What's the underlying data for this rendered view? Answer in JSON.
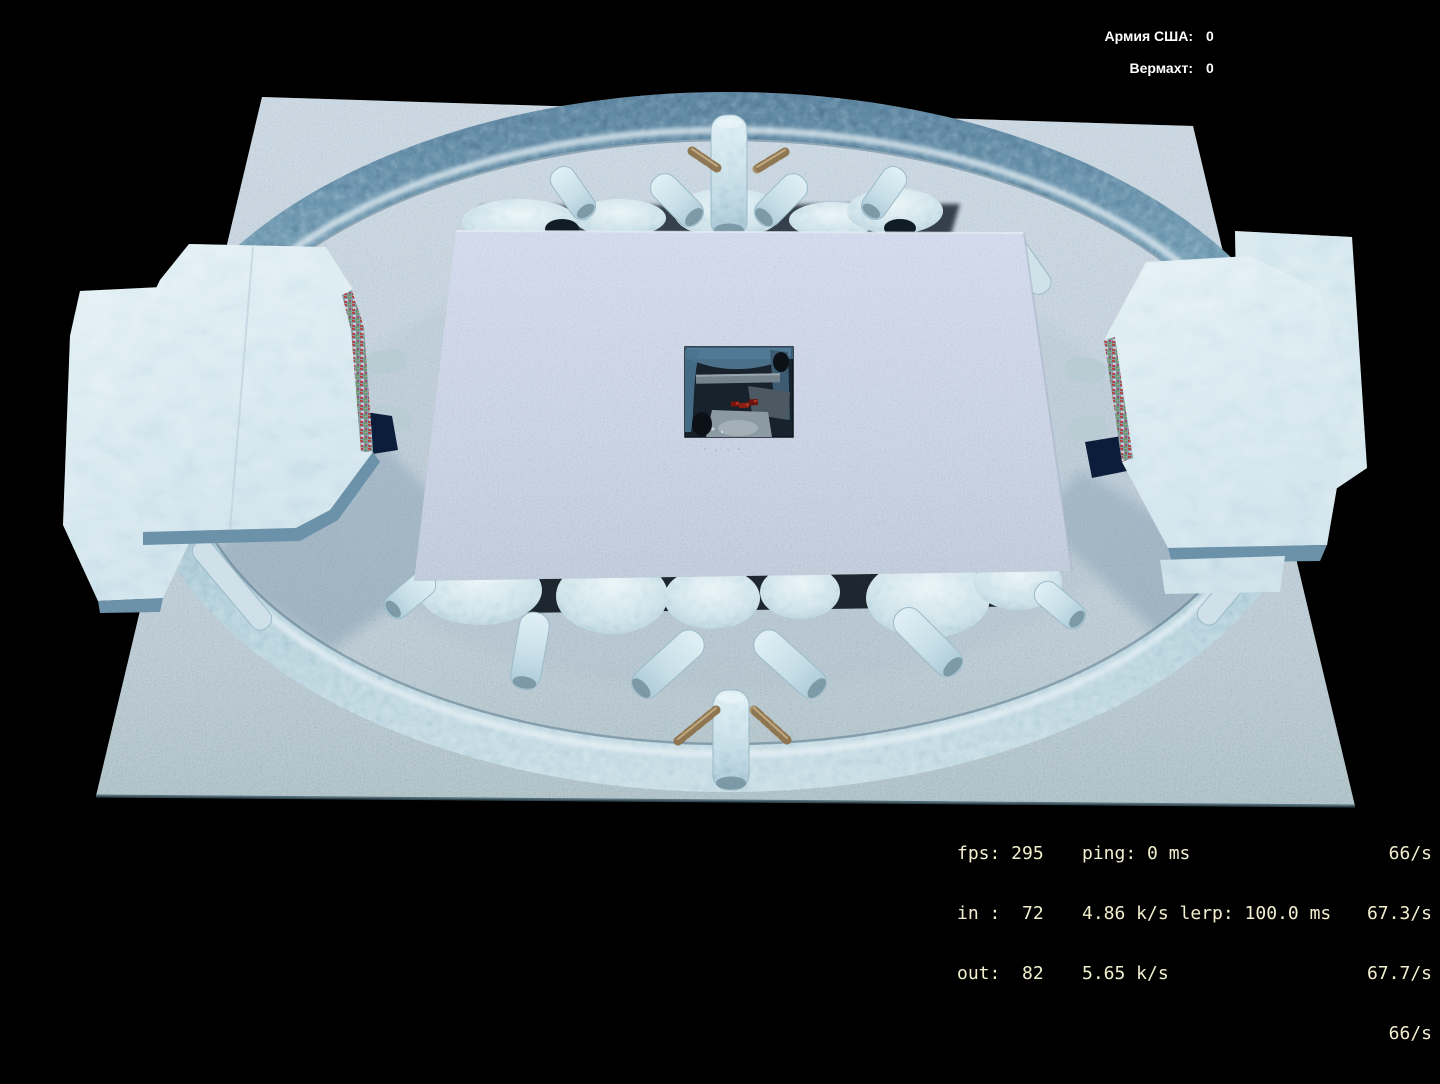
{
  "hud": {
    "scoreboard": {
      "rows": [
        {
          "label": "Армия США:",
          "value": "0"
        },
        {
          "label": "Вермахт:",
          "value": "0"
        }
      ]
    },
    "netgraph": {
      "col1": [
        "fps: 295",
        "in :  72",
        "out:  82"
      ],
      "col2": [
        "ping: 0 ms",
        "4.86 k/s lerp: 100.0 ms",
        "5.65 k/s"
      ],
      "rates": [
        "66/s",
        "67.3/s",
        "67.7/s",
        "66/s"
      ]
    }
  },
  "theme": {
    "background": "#000000",
    "ground": "#c5d2dd",
    "ring_ice": "#7aa2b8",
    "platform": "#ccd5e6",
    "slab_ice": "#ddedf2",
    "slab_side": "#6b92a9",
    "pit_dark": "#18222c",
    "marker_red": "#8e2013",
    "wood": "#a8906a",
    "score_text": "#ffffff",
    "netgraph_text": "#f2efcf"
  }
}
